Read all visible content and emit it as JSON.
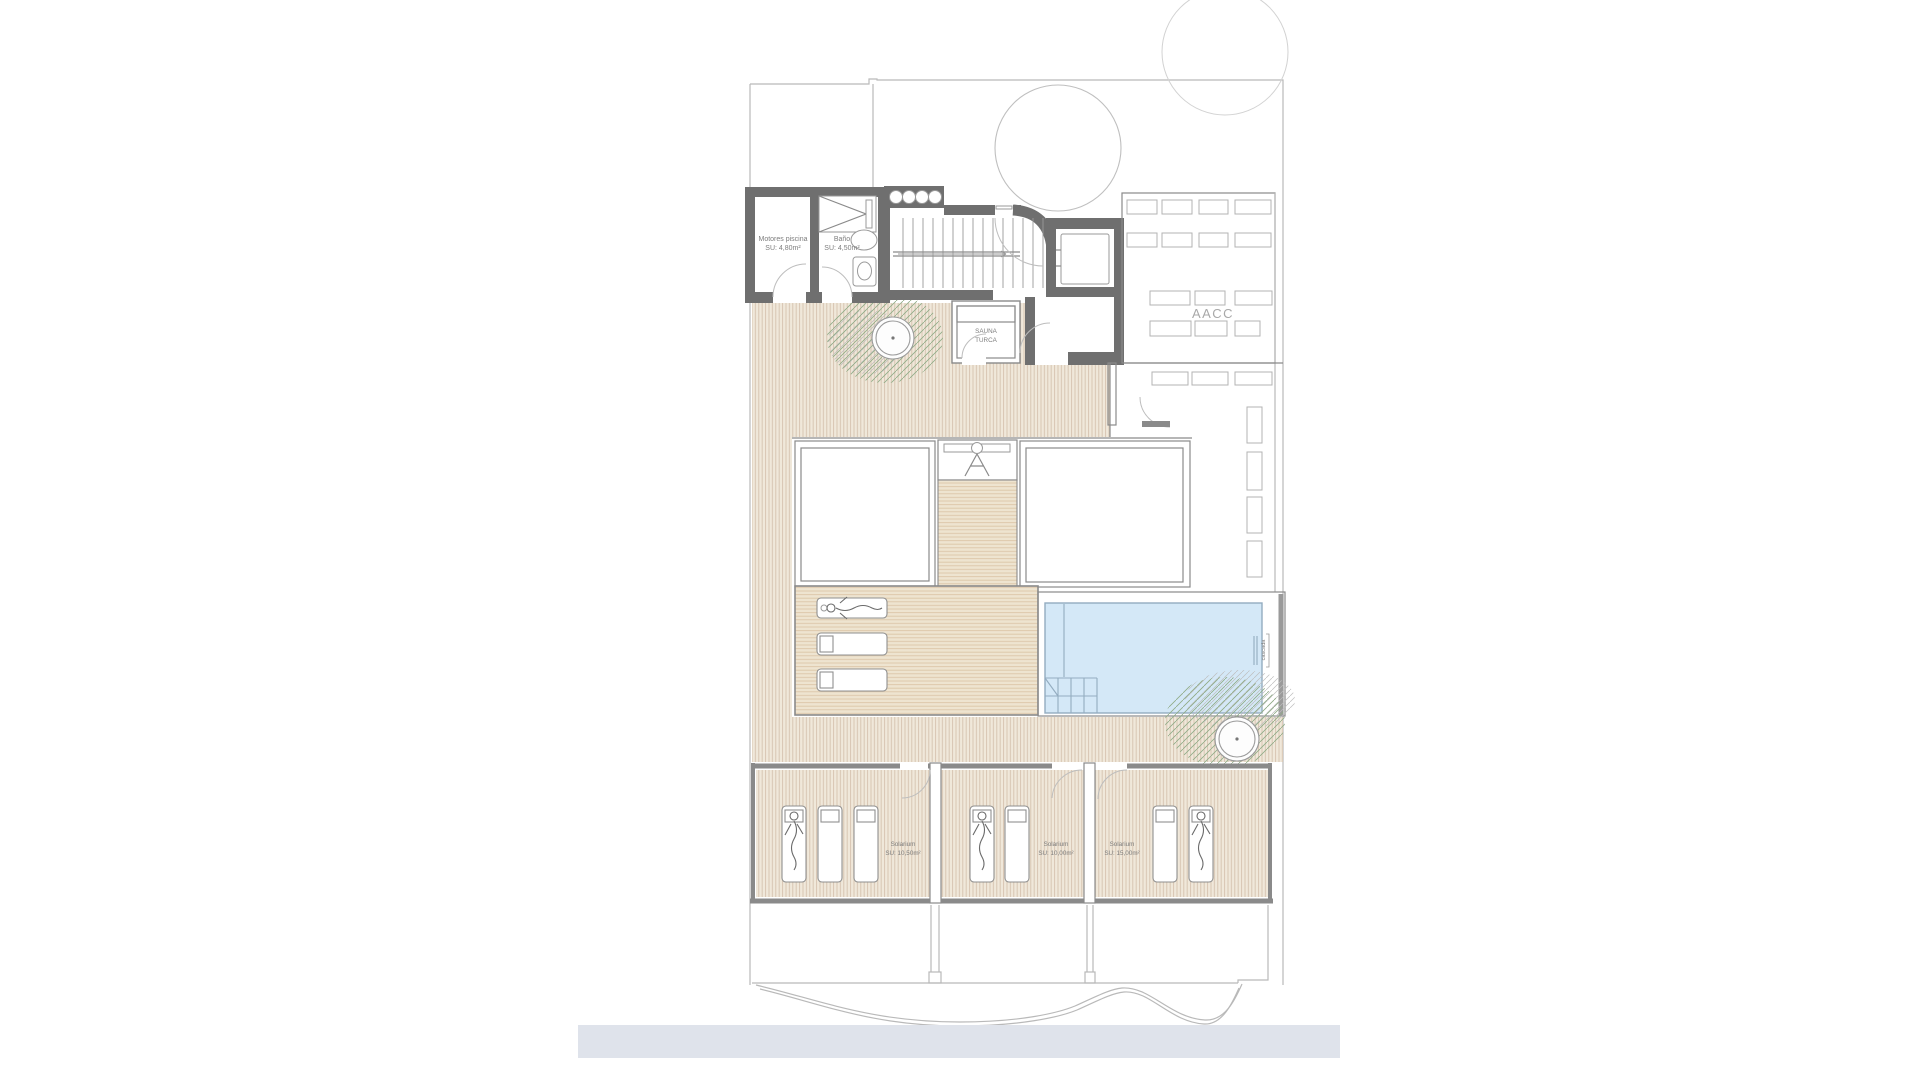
{
  "colors": {
    "background": "#ffffff",
    "wall": "#6f6f6f",
    "line": "#8a8a8a",
    "boundary": "#b9b9b9",
    "deck_base": "#f0e8da",
    "deck_stripe": "#d5c2ae",
    "deck2_base": "#eee4d0",
    "deck2_stripe": "#dcc6a8",
    "pool_fill": "#d4e8f7",
    "pool_edge": "#93acc0",
    "green": "#8fab86",
    "footer_bar": "#dfe3eb",
    "text": "#7d7d7d"
  },
  "labels": {
    "motores": {
      "name": "Motores piscina",
      "area": "SU: 4,80m²"
    },
    "bano": {
      "name": "Baño",
      "area": "SU: 4,50m²"
    },
    "sauna": {
      "line1": "SAUNA",
      "line2": "TURCA"
    },
    "aacc": "AACC",
    "cascada": "cascada",
    "solarium_left": {
      "name": "Solarium",
      "area": "SU: 10,50m²"
    },
    "solarium_middle": {
      "name": "Solarium",
      "area": "SU: 10,00m²"
    },
    "solarium_right": {
      "name": "Solarium",
      "area": "SU: 15,00m²"
    }
  }
}
